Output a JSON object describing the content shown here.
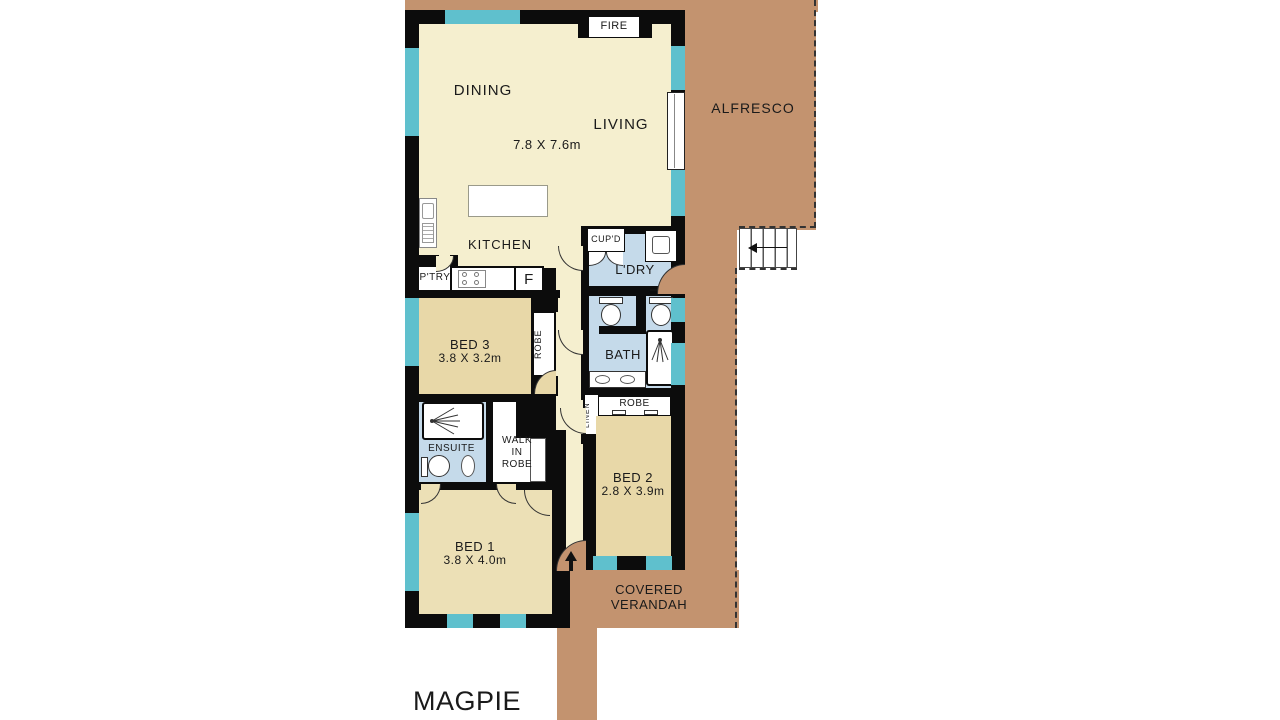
{
  "title": "MAGPIE 3",
  "colors": {
    "verandah": "#c3936f",
    "wall": "#0c0c0c",
    "room_cream": "#f5efcf",
    "bedroom_tan": "#e8d8a8",
    "bed1_tan": "#ece0b6",
    "wet_blue": "#c5daea",
    "window_teal": "#5fc0cd"
  },
  "rooms": {
    "dining": {
      "label": "DINING"
    },
    "living": {
      "label": "LIVING",
      "dims": "7.8 X 7.6m"
    },
    "kitchen": {
      "label": "KITCHEN"
    },
    "pantry": {
      "label": "P'TRY"
    },
    "fridge": {
      "label": "F"
    },
    "fire": {
      "label": "FIRE"
    },
    "bed3": {
      "label": "BED 3",
      "dims": "3.8 X 3.2m"
    },
    "robe3": {
      "label": "ROBE"
    },
    "cupboard": {
      "label": "CUP'D"
    },
    "laundry": {
      "label": "L'DRY"
    },
    "bath": {
      "label": "BATH"
    },
    "robe2": {
      "label": "ROBE"
    },
    "linen": {
      "label": "LINEN"
    },
    "bed2": {
      "label": "BED 2",
      "dims": "2.8 X 3.9m"
    },
    "ensuite": {
      "label": "ENSUITE"
    },
    "walk_in_robe": {
      "label": "WALK\nIN\nROBE"
    },
    "bed1": {
      "label": "BED 1",
      "dims": "3.8 X 4.0m"
    },
    "alfresco": {
      "label": "ALFRESCO"
    },
    "covered_verandah": {
      "label": "COVERED\nVERANDAH"
    }
  }
}
